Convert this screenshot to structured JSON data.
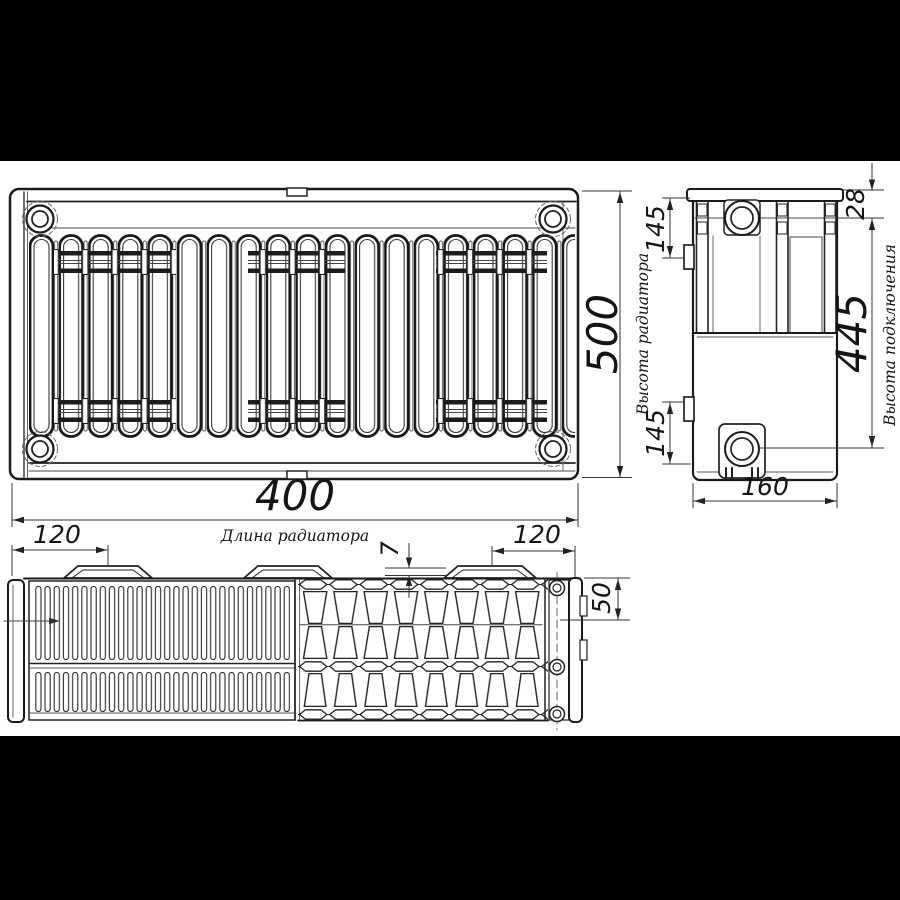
{
  "drawing": {
    "type": "radiator-technical-drawing",
    "colors": {
      "letterbox": "#000000",
      "paper": "#ffffff",
      "line": "#1a1a1a"
    },
    "dimensions": {
      "length": {
        "value": "400",
        "label": "Длина радиатора"
      },
      "height": {
        "value": "500",
        "label": "Высота радиатора"
      },
      "depth": {
        "value": "160"
      },
      "connection_height": {
        "value": "445",
        "label": "Высота подключения"
      },
      "top_bracket_offset": {
        "value": "145"
      },
      "bottom_bracket_offset": {
        "value": "145"
      },
      "top_pipe_offset": {
        "value": "28"
      },
      "bracket_offset_left": {
        "value": "120"
      },
      "bracket_offset_right": {
        "value": "120"
      },
      "bracket_plate_thickness": {
        "value": "7"
      },
      "top_depth_offset": {
        "value": "50"
      }
    }
  }
}
